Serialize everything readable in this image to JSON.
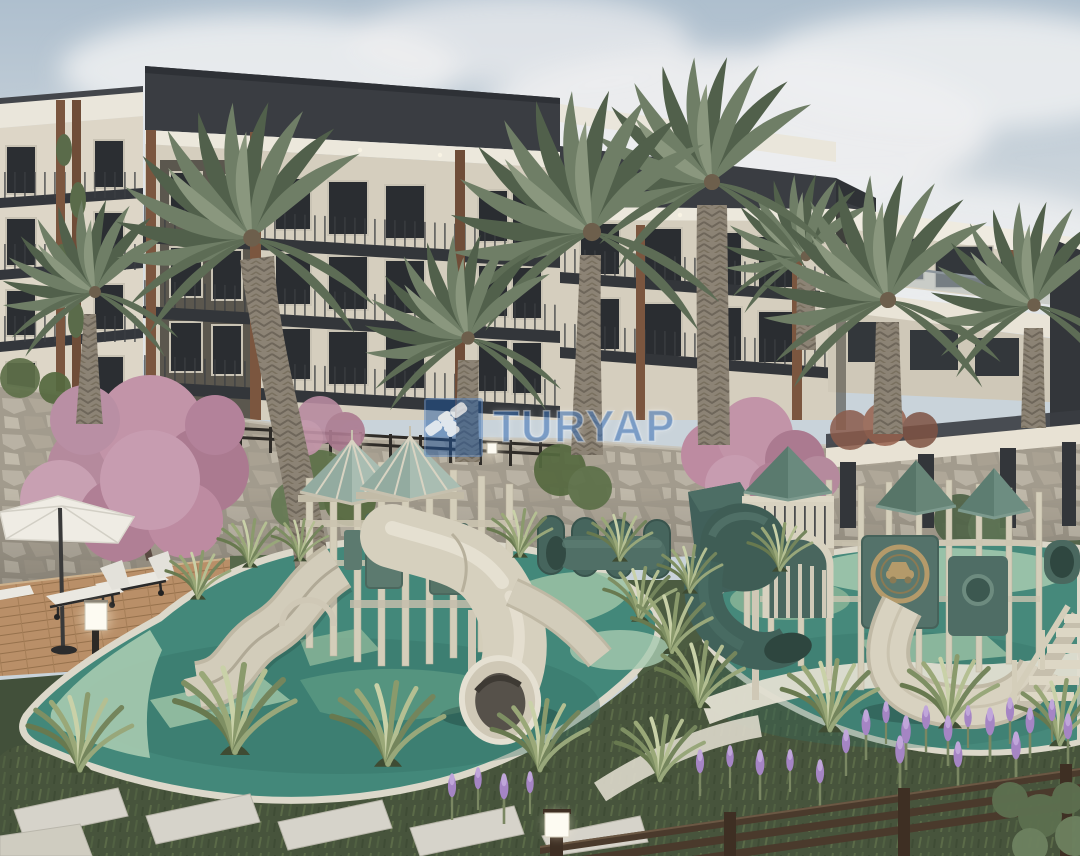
{
  "watermark": {
    "text": "TURYAP",
    "icon": "handshake-icon",
    "brand_blue": "#2460ac",
    "icon_background": "#1c56a3"
  },
  "scene": {
    "type": "architectural-3d-render",
    "setting": "residential complex courtyard with children's playground, palm garden and sun deck",
    "elements": [
      "apartment-building",
      "penthouse-building",
      "palm-trees",
      "cherry-blossom-trees",
      "stone-retaining-wall",
      "wall-railing",
      "pergola",
      "playground-gazebo-towers",
      "wavy-double-slide",
      "tube-slide",
      "spiral-slide",
      "curved-slide",
      "play-tunnels",
      "rubber-safety-flooring",
      "walkway",
      "wooden-deck",
      "patio-umbrella",
      "sun-loungers",
      "cube-lamps",
      "ornamental-grasses",
      "lavender-flowers",
      "stepping-stones",
      "garden-fence"
    ]
  },
  "palette": {
    "sky": "#c2cfd8",
    "clouds": "#eceeee",
    "building_roof": "#3a3d42",
    "building_facade": "#d8d1c1",
    "wood_accent": "#7b563f",
    "window_glass": "#2b2e32",
    "right_building_slab": "#eeeae0",
    "stone_wall": "#a89f90",
    "blossom_pink": "#c294a8",
    "palm_green": "#6a7962",
    "rubber_floor_teal": "#43887a",
    "path_mint": "#a7cbb0",
    "play_structure_beige": "#d2ccba",
    "play_structure_teal": "#5c7a6f",
    "play_roof_teal": "#5e7d72",
    "grass_green": "#47543c",
    "plant_blades": "#9aa878",
    "lavender": "#a585c4",
    "deck_wood": "#b98f68",
    "fence_brown": "#4a3a2c",
    "lamp_glow": "#fdfbf2"
  }
}
